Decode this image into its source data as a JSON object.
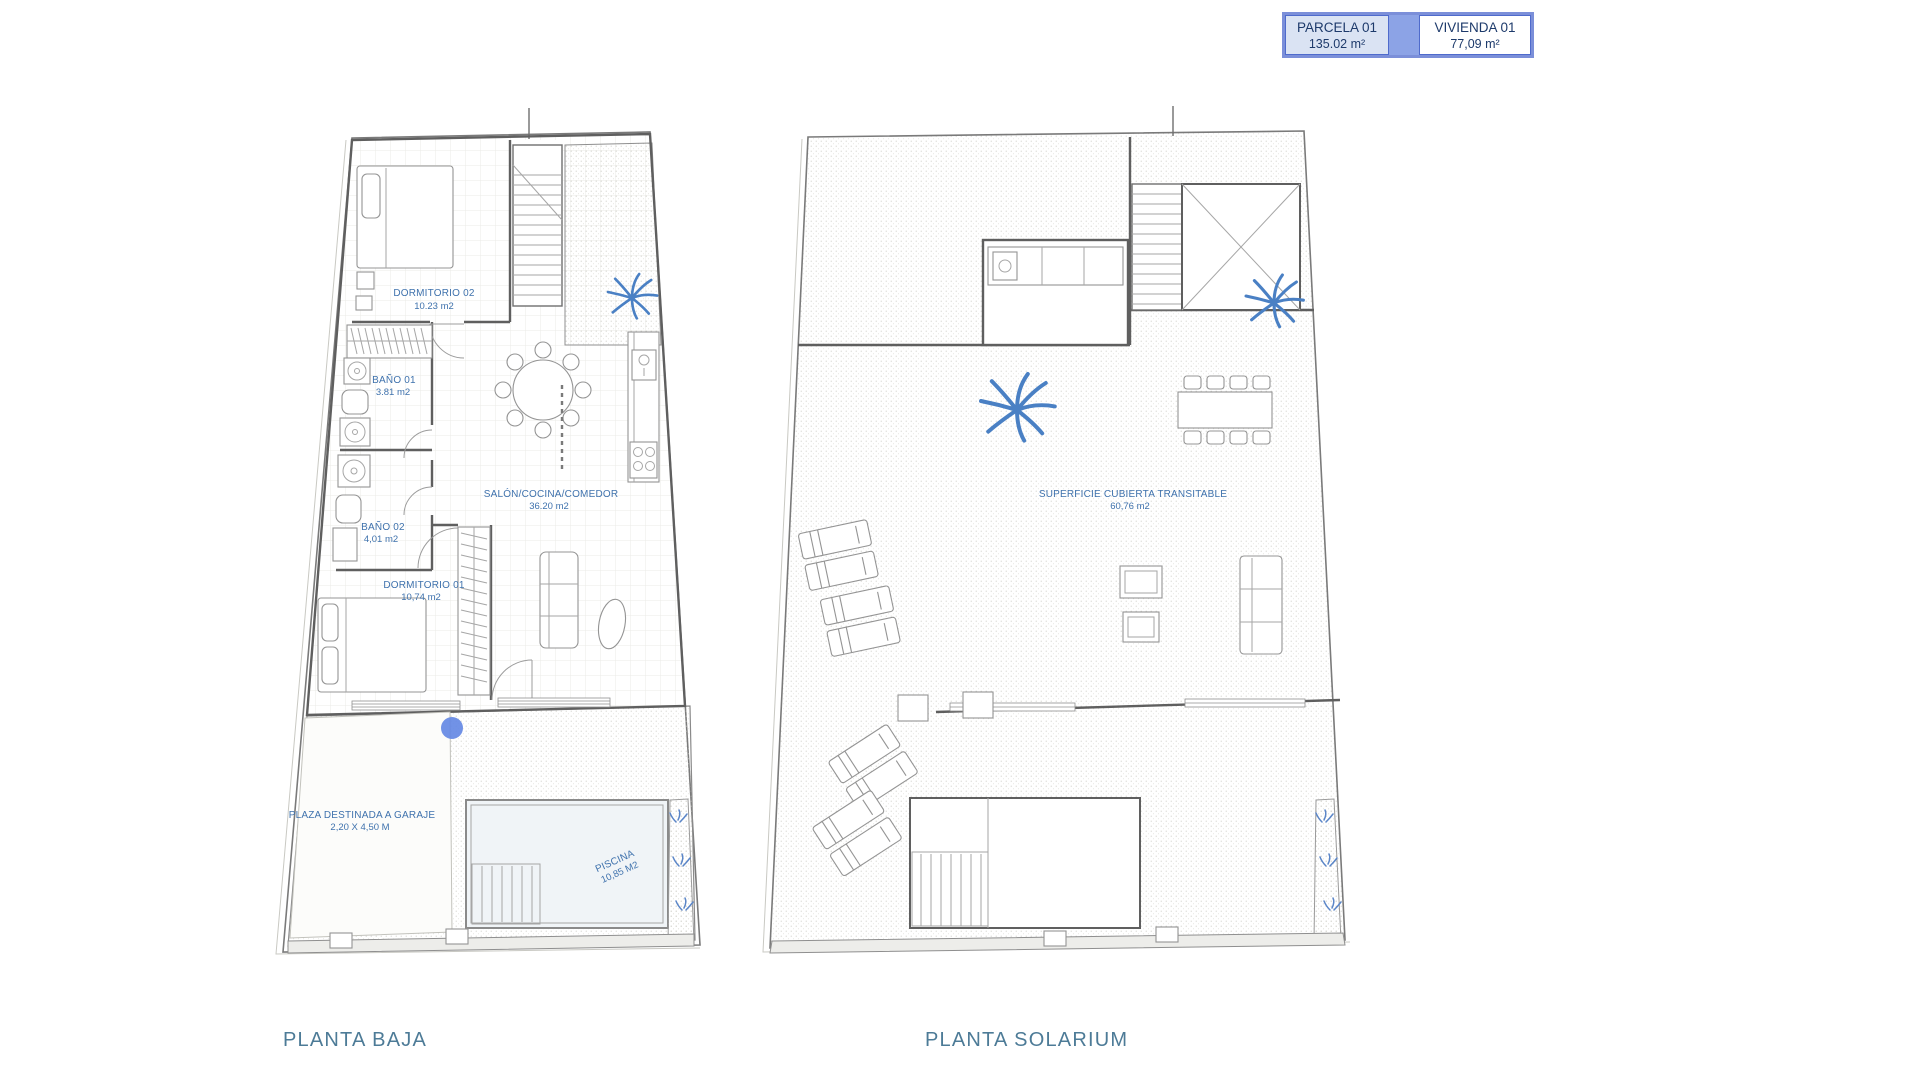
{
  "header": {
    "parcela": {
      "label": "PARCELA 01",
      "area": "135.02 m²"
    },
    "vivienda": {
      "label": "VIVIENDA 01",
      "area": "77,09 m²"
    }
  },
  "plans": {
    "baja": {
      "title": "PLANTA BAJA",
      "rooms": {
        "dormitorio02": {
          "name": "DORMITORIO 02",
          "area": "10.23 m2"
        },
        "bano01": {
          "name": "BAÑO 01",
          "area": "3.81 m2"
        },
        "bano02": {
          "name": "BAÑO 02",
          "area": "4,01 m2"
        },
        "dormitorio01": {
          "name": "DORMITORIO 01",
          "area": "10,74 m2"
        },
        "salon": {
          "name": "SALÓN/COCINA/COMEDOR",
          "area": "36.20 m2"
        },
        "garaje": {
          "name": "PLAZA DESTINADA A GARAJE",
          "area": "2,20 X 4,50 M"
        },
        "piscina": {
          "name": "PISCINA",
          "area": "10,85 M2"
        }
      }
    },
    "solarium": {
      "title": "PLANTA SOLARIUM",
      "rooms": {
        "cubierta": {
          "name": "SUPERFICIE CUBIERTA TRANSITABLE",
          "area": "60,76 m2"
        }
      }
    }
  },
  "colors": {
    "label_text": "#3f72ad",
    "plan_title": "#4d7b97",
    "header_text": "#1d3a6b",
    "header_border": "#7b8fd9",
    "header_fill_parcela": "#dae3f3",
    "header_fill_gap": "#8ca3e6",
    "header_fill_vivienda": "#ffffff",
    "palm_blue": "#4a80c4",
    "garden_plant_blue": "#5b86c8",
    "marker_dot": "#6286e3",
    "wall_grey": "#5f5f5f"
  }
}
